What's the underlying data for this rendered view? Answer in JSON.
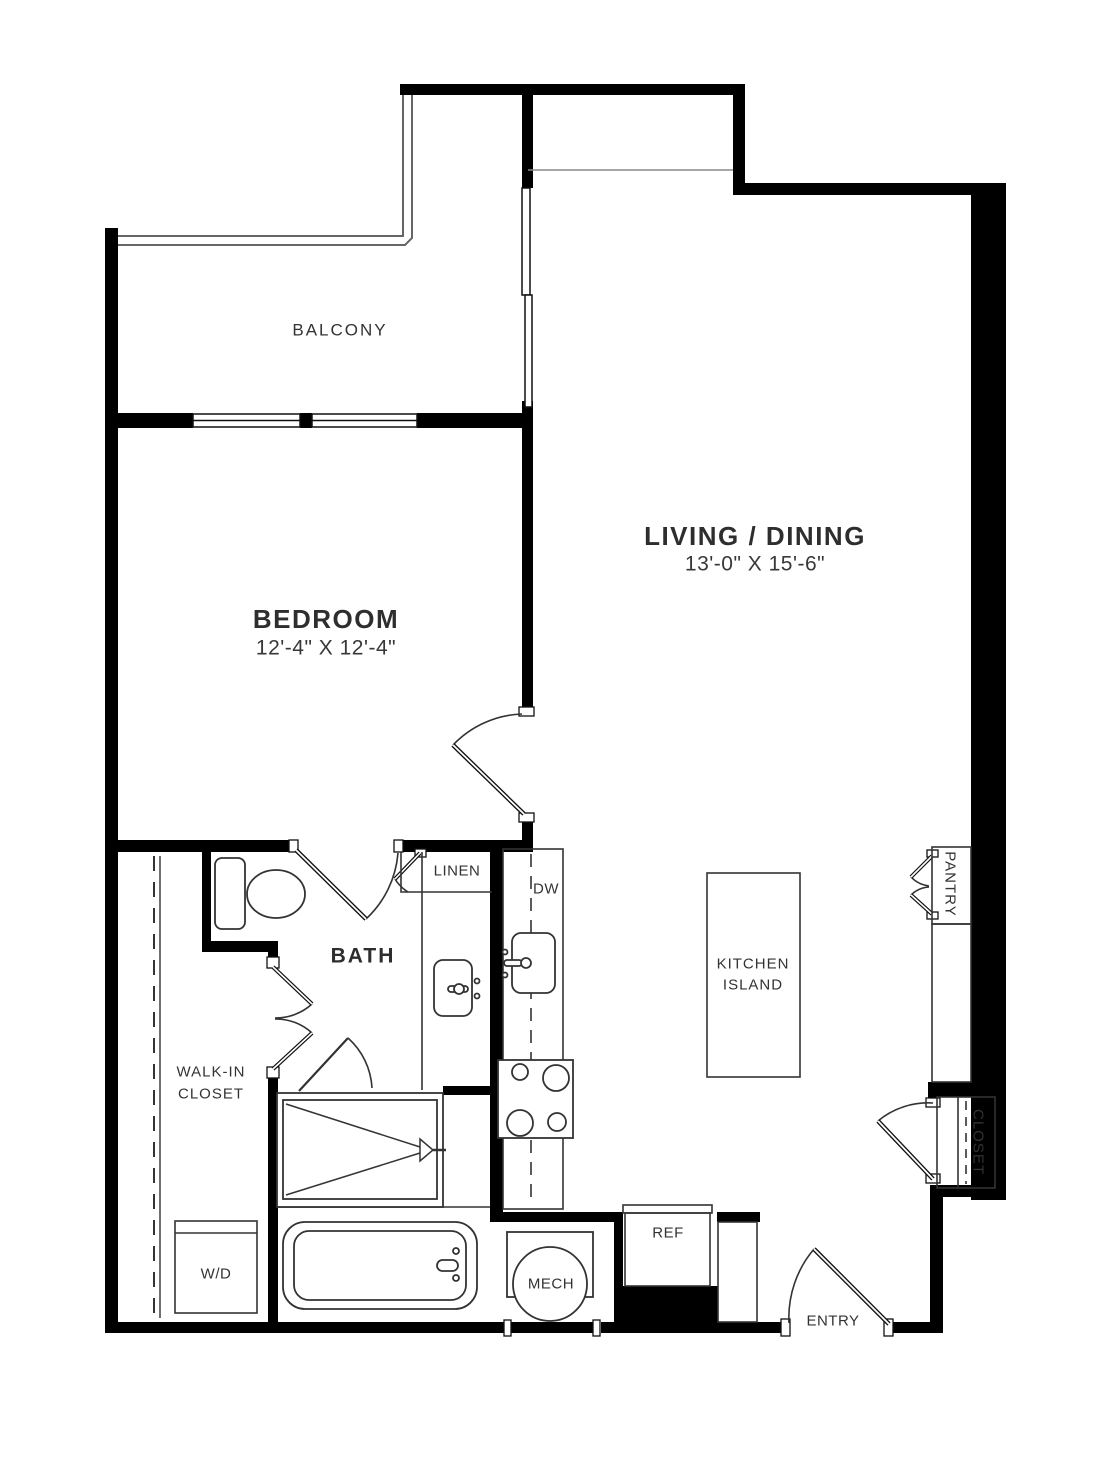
{
  "plan": {
    "title": "One-bedroom apartment floor plan",
    "rooms": {
      "balcony": {
        "label": "BALCONY"
      },
      "bedroom": {
        "label": "BEDROOM",
        "dimensions": "12'-4\" X 12'-4\""
      },
      "living_dining": {
        "label": "LIVING / DINING",
        "dimensions": "13'-0\" X 15'-6\""
      },
      "bath": {
        "label": "BATH"
      },
      "linen": {
        "label": "LINEN"
      },
      "walk_in_closet": {
        "label_line1": "WALK-IN",
        "label_line2": "CLOSET"
      },
      "pantry": {
        "label": "PANTRY"
      },
      "entry_closet": {
        "label": "CLOSET"
      },
      "entry": {
        "label": "ENTRY"
      }
    },
    "fixtures": {
      "dishwasher": {
        "label": "DW"
      },
      "kitchen_island": {
        "label_line1": "KITCHEN",
        "label_line2": "ISLAND"
      },
      "washer_dryer": {
        "label": "W/D"
      },
      "refrigerator": {
        "label": "REF"
      },
      "mechanical": {
        "label": "MECH"
      }
    },
    "colors": {
      "wall": "#000000",
      "fixture_line": "#333333",
      "railing_line": "#666666",
      "text": "#2e2e2e",
      "background": "#ffffff"
    }
  }
}
